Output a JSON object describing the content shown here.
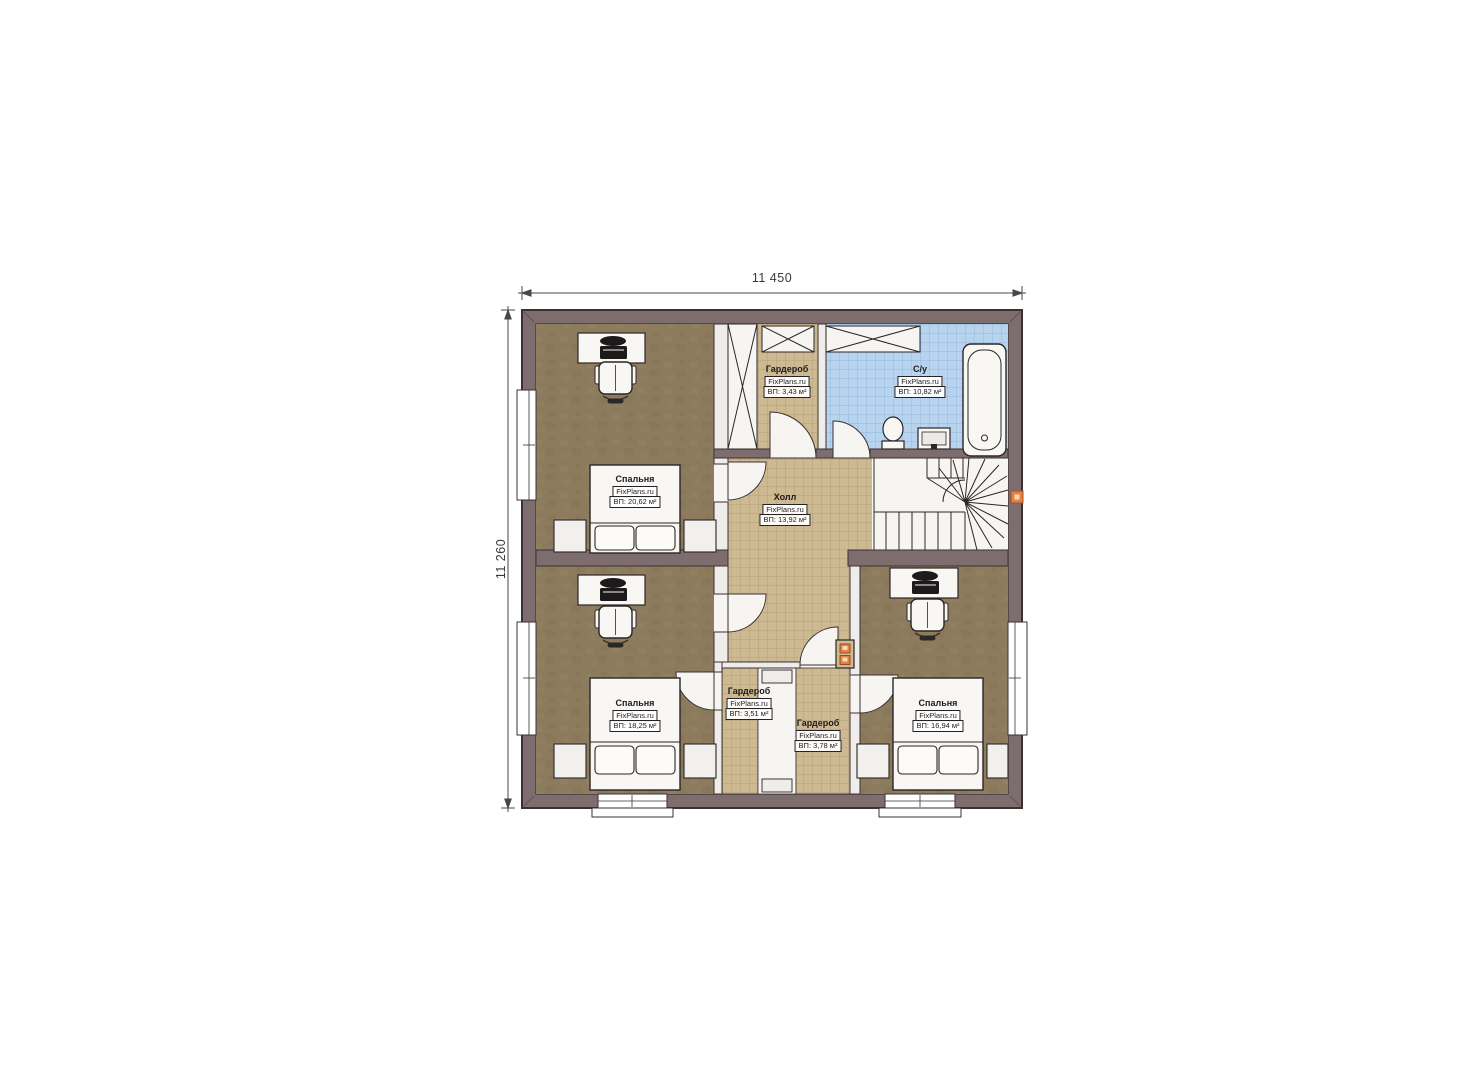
{
  "plan": {
    "dimensions": {
      "top": "11 450",
      "left": "11 260"
    },
    "rooms": {
      "bedroom_top_left": {
        "name": "Спальня",
        "brand": "FixPlans.ru",
        "area": "ВП: 20,62 м²"
      },
      "wardrobe_top": {
        "name": "Гардероб",
        "brand": "FixPlans.ru",
        "area": "ВП: 3,43 м²"
      },
      "bathroom": {
        "name": "С/у",
        "brand": "FixPlans.ru",
        "area": "ВП: 10,82 м²"
      },
      "hall": {
        "name": "Холл",
        "brand": "FixPlans.ru",
        "area": "ВП: 13,92 м²"
      },
      "bedroom_bottom_left": {
        "name": "Спальня",
        "brand": "FixPlans.ru",
        "area": "ВП: 18,25 м²"
      },
      "wardrobe_bottom_left": {
        "name": "Гардероб",
        "brand": "FixPlans.ru",
        "area": "ВП: 3,51 м²"
      },
      "wardrobe_bottom_right": {
        "name": "Гардероб",
        "brand": "FixPlans.ru",
        "area": "ВП: 3,78 м²"
      },
      "bedroom_bottom_right": {
        "name": "Спальня",
        "brand": "FixPlans.ru",
        "area": "ВП: 16,94 м²"
      }
    },
    "colors": {
      "wall": "#7e6d6f",
      "bedroom_floor": "#8d7b5e",
      "tile_beige": "#cdb992",
      "tile_blue": "#b8d3ee",
      "accent_orange": "#e8813f"
    }
  }
}
